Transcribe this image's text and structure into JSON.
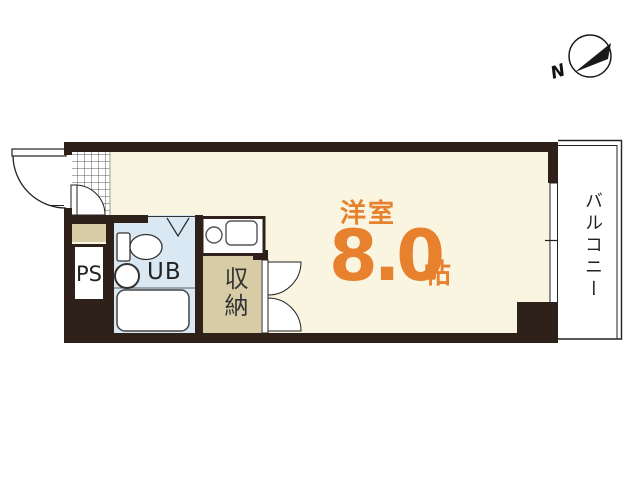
{
  "plan": {
    "main_room": {
      "name": "洋室",
      "size": "8.0",
      "unit": "帖"
    },
    "unit_bath_label": "UB",
    "pipe_space_label": "PS",
    "closet_label": "収納",
    "balcony_label": "バルコニー",
    "compass_north_label": "N"
  },
  "colors": {
    "wall": "#2d211a",
    "room_floor": "#faf5e1",
    "tan_floor": "#d8cca7",
    "bath_blue": "#d9e8f3",
    "accent_orange": "#e8812e",
    "line": "#222222"
  }
}
